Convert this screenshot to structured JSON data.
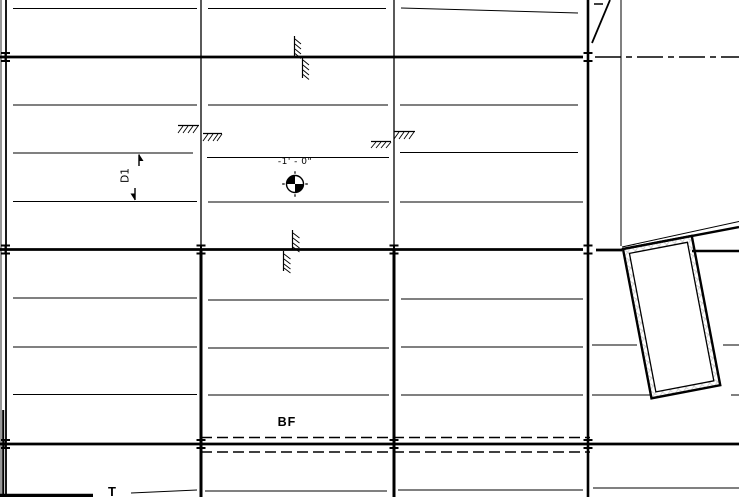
{
  "labels": {
    "spot_elevation": "-1' - 0\"",
    "deck_span": "D1",
    "braced_frame": "BF",
    "bottom_truncated": "T"
  },
  "colors": {
    "line": "#000000",
    "background": "#ffffff",
    "screen_edge_gray": "#8c8c8c",
    "wall_hatch_gray": "#cccccc"
  },
  "symbols": {
    "spot_target": "spot-elevation-target-icon",
    "columns": "steel-column-icon",
    "step_hatches": "foundation-step-hatch-icon",
    "span_arrows": "deck-span-arrow-icon",
    "centerline": "dash-dot-centerline",
    "braced_frame_extent": "dashed-brace-lines"
  }
}
